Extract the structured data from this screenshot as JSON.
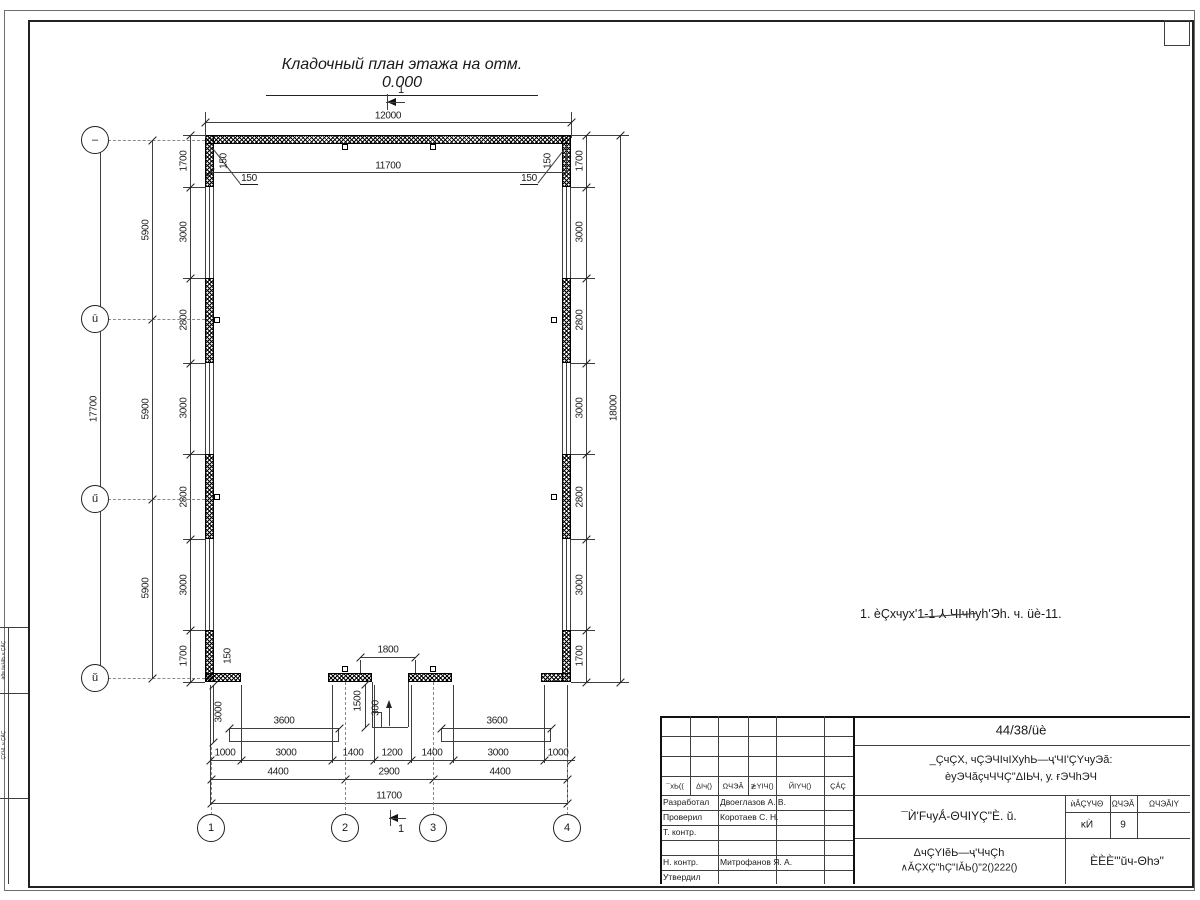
{
  "title": "Кладочный план этажа на отм. 0.000",
  "note": "1. èÇхчух'1-1 ⅄ ЧΙчhуh'Эh. ч. üè-11.",
  "section_label": "1",
  "axes": {
    "left": [
      {
        "label": "–",
        "x": 95,
        "y": 140
      },
      {
        "label": "ū",
        "x": 95,
        "y": 319
      },
      {
        "label": "ű",
        "x": 95,
        "y": 499
      },
      {
        "label": "ŭ",
        "x": 95,
        "y": 678
      }
    ],
    "bottom": [
      {
        "label": "1",
        "x": 211,
        "y": 828
      },
      {
        "label": "2",
        "x": 345,
        "y": 828
      },
      {
        "label": "3",
        "x": 433,
        "y": 828
      },
      {
        "label": "4",
        "x": 567,
        "y": 828
      }
    ]
  },
  "dimensions": [
    {
      "t": "12000",
      "x": 388,
      "y": 116
    },
    {
      "t": "11700",
      "x": 388,
      "y": 166
    },
    {
      "t": "150",
      "x": 224,
      "y": 161,
      "v": 1
    },
    {
      "t": "150",
      "x": 548,
      "y": 161,
      "v": 1
    },
    {
      "t": "150",
      "x": 249,
      "y": 179,
      "u": 1
    },
    {
      "t": "150",
      "x": 529,
      "y": 179,
      "u": 1
    },
    {
      "t": "1700",
      "x": 184,
      "y": 161,
      "v": 1
    },
    {
      "t": "3000",
      "x": 184,
      "y": 232,
      "v": 1
    },
    {
      "t": "2800",
      "x": 184,
      "y": 320,
      "v": 1
    },
    {
      "t": "3000",
      "x": 184,
      "y": 408,
      "v": 1
    },
    {
      "t": "2800",
      "x": 184,
      "y": 497,
      "v": 1
    },
    {
      "t": "3000",
      "x": 184,
      "y": 585,
      "v": 1
    },
    {
      "t": "1700",
      "x": 184,
      "y": 656,
      "v": 1
    },
    {
      "t": "5900",
      "x": 146,
      "y": 230,
      "v": 1
    },
    {
      "t": "5900",
      "x": 146,
      "y": 409,
      "v": 1
    },
    {
      "t": "5900",
      "x": 146,
      "y": 588,
      "v": 1
    },
    {
      "t": "17700",
      "x": 94,
      "y": 409,
      "v": 1
    },
    {
      "t": "1700",
      "x": 580,
      "y": 161,
      "v": 1
    },
    {
      "t": "3000",
      "x": 580,
      "y": 232,
      "v": 1
    },
    {
      "t": "2800",
      "x": 580,
      "y": 320,
      "v": 1
    },
    {
      "t": "3000",
      "x": 580,
      "y": 408,
      "v": 1
    },
    {
      "t": "2800",
      "x": 580,
      "y": 497,
      "v": 1
    },
    {
      "t": "3000",
      "x": 580,
      "y": 585,
      "v": 1
    },
    {
      "t": "1700",
      "x": 580,
      "y": 656,
      "v": 1
    },
    {
      "t": "18000",
      "x": 614,
      "y": 408,
      "v": 1
    },
    {
      "t": "1800",
      "x": 388,
      "y": 650
    },
    {
      "t": "1500",
      "x": 358,
      "y": 701,
      "v": 1
    },
    {
      "t": "300",
      "x": 376,
      "y": 708,
      "v": 1
    },
    {
      "t": "3000",
      "x": 219,
      "y": 712,
      "v": 1
    },
    {
      "t": "150",
      "x": 228,
      "y": 656,
      "v": 1
    },
    {
      "t": "3600",
      "x": 284,
      "y": 721
    },
    {
      "t": "3600",
      "x": 497,
      "y": 721
    },
    {
      "t": "1000",
      "x": 225,
      "y": 753
    },
    {
      "t": "3000",
      "x": 286,
      "y": 753
    },
    {
      "t": "1400",
      "x": 353,
      "y": 753
    },
    {
      "t": "1200",
      "x": 392,
      "y": 753
    },
    {
      "t": "1400",
      "x": 432,
      "y": 753
    },
    {
      "t": "3000",
      "x": 498,
      "y": 753
    },
    {
      "t": "1000",
      "x": 558,
      "y": 753
    },
    {
      "t": "4400",
      "x": 278,
      "y": 772
    },
    {
      "t": "2900",
      "x": 389,
      "y": 772
    },
    {
      "t": "4400",
      "x": 500,
      "y": 772
    },
    {
      "t": "11700",
      "x": 389,
      "y": 796
    }
  ],
  "titleblock": {
    "doc_number": "44/38/üè",
    "project_line1": "_ÇчÇХ, чÇЭЧΙчΙХуhЬ—ҷ'ЧΙ'ÇΥчуЭă:",
    "project_line2": "èуЭЧăçчЧЧÇ\"ΔΙЬЧ, у. ғЭЧhЭЧ",
    "drawing_title": "¯Ѝ'FчуǺ-ΘЧΙΥÇ\"È. ŭ.",
    "sheet_caption_line1": "ΔчÇΥΙĕЬ—ҷ'ЧчÇh",
    "sheet_caption_line2": "∧ǍÇXÇ\"hÇ\"ΙǍЬ()\"2()222()",
    "org": "ÈÈÈ'\"ŭч-Θhэ\"",
    "header_cells": [
      "¯хЬ((",
      "ΔΙч()",
      "ΩЧЭǍ",
      "≵ΥΙЧ()",
      "ЙΙΥЧ()",
      "ÇǺÇ"
    ],
    "stage_table": {
      "headers": [
        "ѝǍÇΥЧΘ",
        "ΩЧЭǍ",
        "ΩЧЭǍΙΥ"
      ],
      "stage": "ĸЍ",
      "sheet": "9",
      "sheets": ""
    },
    "roles": [
      {
        "label": "Разработал",
        "name": "Двоеглазов А. В."
      },
      {
        "label": "Проверил",
        "name": "Коротаев С. Н."
      },
      {
        "label": "Т. контр.",
        "name": ""
      },
      {
        "label": "",
        "name": ""
      },
      {
        "label": "Н. контр.",
        "name": "Митрофанов Я. А."
      },
      {
        "label": "Утвердил",
        "name": ""
      }
    ]
  },
  "side_strip": [
    "ѝθʙ №ЧΙЬ ч ÇÀÇ",
    "ÇΥЧΙ. ч ÇÀÇ"
  ]
}
